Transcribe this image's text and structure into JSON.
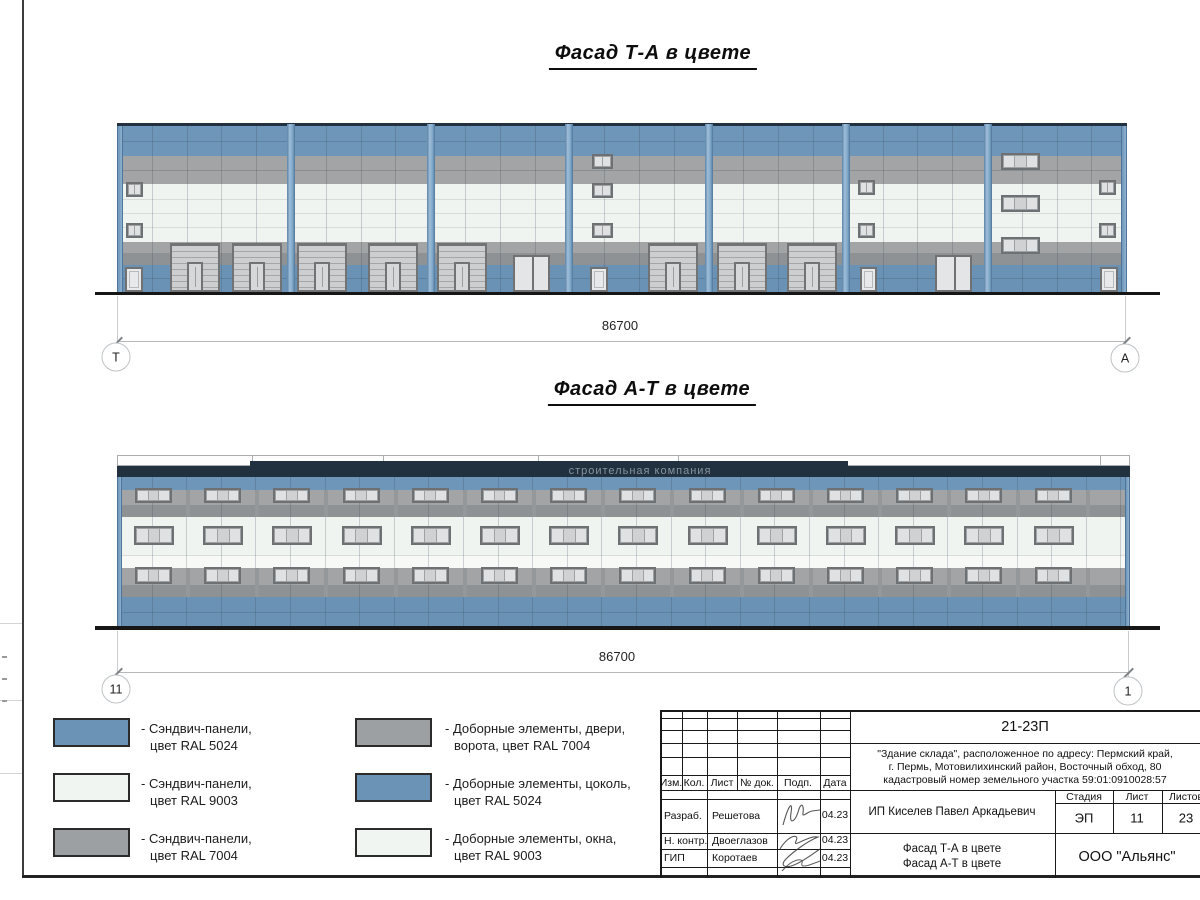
{
  "palette": {
    "blue": "#6e96b8",
    "blue_socle": "#6a92b4",
    "white_panel": "#f0f4f1",
    "white_panel2": "#f6f9f6",
    "gray": "#a2a4a6",
    "gray_dark": "#8f9294",
    "parapet": "#22313f",
    "joint": "rgba(50,65,80,0.22)",
    "white_joint": "#d9ddda",
    "ground": "#161616"
  },
  "titles": {
    "facade_ta": "Фасад Т-А в цвете",
    "facade_at": "Фасад А-Т в цвете"
  },
  "watermark": {
    "text": "строительная компания"
  },
  "dims": {
    "ta": {
      "value": "86700",
      "left": "Т",
      "right": "А"
    },
    "at": {
      "value": "86700",
      "left": "11",
      "right": "1"
    }
  },
  "legend": [
    {
      "swatch": "#6b93b6",
      "line1": "- Сэндвич-панели,",
      "line2": "цвет RAL 5024"
    },
    {
      "swatch": "#f1f5f2",
      "line1": "- Сэндвич-панели,",
      "line2": "цвет RAL 9003"
    },
    {
      "swatch": "#9da0a2",
      "line1": "- Сэндвич-панели,",
      "line2": "цвет RAL 7004"
    },
    {
      "swatch": "#9da0a2",
      "line1": "- Доборные элементы, двери,",
      "line2": "ворота, цвет RAL 7004"
    },
    {
      "swatch": "#6b93b6",
      "line1": "- Доборные элементы, цоколь,",
      "line2": "цвет RAL 5024"
    },
    {
      "swatch": "#f1f5f2",
      "line1": "- Доборные элементы, окна,",
      "line2": "цвет RAL 9003"
    }
  ],
  "title_block": {
    "doc_number": "21-23П",
    "address_lines": [
      "\"Здание склада\", расположенное по адресу: Пермский край,",
      "г. Пермь, Мотовилихинский район, Восточный обход, 80",
      "кадастровый номер земельного участка 59:01:0910028:57"
    ],
    "columns": [
      "Изм.",
      "Кол.",
      "Лист",
      "№ док.",
      "Подп.",
      "Дата"
    ],
    "signers": [
      {
        "role": "Разраб.",
        "name": "Решетова",
        "date": "04.23"
      },
      {
        "role": "Н. контр.",
        "name": "Двоеглазов",
        "date": "04.23"
      },
      {
        "role": "ГИП",
        "name": "Коротаев",
        "date": "04.23"
      }
    ],
    "client": "ИП Киселев Павел Аркадьевич",
    "stage_cols": [
      "Стадия",
      "Лист",
      "Листов"
    ],
    "stage_vals": [
      "ЭП",
      "11",
      "23"
    ],
    "sheet_titles": [
      "Фасад Т-А в цвете",
      "Фасад А-Т в цвете"
    ],
    "company": "ООО \"Альянс\""
  },
  "drawing": {
    "facade_ta": {
      "x": 117,
      "w": 1010,
      "top": 123,
      "bottom": 292,
      "bands": [
        {
          "y": 126,
          "h": 30,
          "color": "blue",
          "joints": [
            141
          ]
        },
        {
          "y": 156,
          "h": 28,
          "color": "gray",
          "joints": [
            170
          ]
        },
        {
          "y": 184,
          "h": 58,
          "color": "white_panel",
          "joints": [
            199,
            213,
            227
          ],
          "jcolor": "white_joint"
        },
        {
          "y": 242,
          "h": 23,
          "color": "gray",
          "dark_from": 253
        },
        {
          "y": 265,
          "h": 27,
          "color": "blue_socle",
          "joints": [
            278
          ]
        }
      ],
      "vstep": 34.8,
      "pilasters": [
        287,
        427,
        565,
        705,
        842,
        984
      ],
      "gates": {
        "xs": [
          170,
          232,
          297,
          368,
          437,
          648,
          717,
          787
        ],
        "y": 243,
        "w": 50,
        "h": 49
      },
      "doors": [
        [
          125,
          267,
          18,
          25
        ],
        [
          590,
          267,
          18,
          25
        ],
        [
          860,
          267,
          17,
          25
        ],
        [
          1100,
          267,
          18,
          25
        ]
      ],
      "double_doors": [
        [
          513,
          255,
          37,
          37
        ],
        [
          935,
          255,
          37,
          37
        ]
      ],
      "windows": [
        [
          126,
          182,
          17,
          15,
          2
        ],
        [
          126,
          223,
          17,
          15,
          2
        ],
        [
          858,
          180,
          17,
          15,
          2
        ],
        [
          858,
          223,
          17,
          15,
          2
        ],
        [
          1099,
          180,
          17,
          15,
          2
        ],
        [
          1099,
          223,
          17,
          15,
          2
        ],
        [
          592,
          154,
          21,
          15,
          2
        ],
        [
          592,
          183,
          21,
          15,
          2
        ],
        [
          592,
          223,
          21,
          15,
          2
        ],
        [
          1001,
          153,
          39,
          17,
          3
        ],
        [
          1001,
          195,
          39,
          17,
          3
        ],
        [
          1001,
          237,
          39,
          17,
          3
        ]
      ],
      "ground": [
        95,
        292,
        1065,
        3
      ]
    },
    "facade_at": {
      "x": 117,
      "w": 1013,
      "top": 455,
      "bottom": 627,
      "cap": {
        "y": 455,
        "h": 11,
        "joints": [
          252,
          383,
          538,
          678,
          1100
        ]
      },
      "parapet": {
        "y": 466,
        "h": 11,
        "raised": {
          "x": 250,
          "w": 598,
          "y": 461,
          "h": 16
        }
      },
      "bands": [
        {
          "y": 477,
          "h": 13,
          "color": "blue"
        },
        {
          "y": 490,
          "h": 27,
          "color": "gray",
          "dark_from": 505
        },
        {
          "y": 517,
          "h": 38,
          "color": "white_panel"
        },
        {
          "y": 555,
          "h": 13,
          "color": "white_panel2",
          "joints": [
            555
          ],
          "jcolor": "white_joint"
        },
        {
          "y": 568,
          "h": 29,
          "color": "gray",
          "dark_from": 585
        },
        {
          "y": 597,
          "h": 31,
          "color": "blue_socle",
          "joints": [
            612
          ]
        }
      ],
      "vstep": 34.6,
      "strip_x0": 186,
      "strip_step": 69.2,
      "strip_w": 4,
      "win_x0": 135,
      "win_step": 69.2,
      "win_count": 14,
      "win_rows": [
        {
          "y": 488,
          "h": 15,
          "w": 37,
          "dx": 0
        },
        {
          "y": 526,
          "h": 19,
          "w": 40,
          "dx": -1
        },
        {
          "y": 567,
          "h": 17,
          "w": 37,
          "dx": 0
        }
      ],
      "ground": [
        95,
        626,
        1065,
        4
      ]
    },
    "dim_ta": {
      "line_y": 341,
      "x1": 117,
      "x2": 1125,
      "ext_top": 296,
      "label_x": 620,
      "label_y": 318,
      "m_left": [
        116,
        357
      ],
      "m_right": [
        1125,
        358
      ]
    },
    "dim_at": {
      "line_y": 672,
      "x1": 117,
      "x2": 1128,
      "ext_top": 631,
      "label_x": 617,
      "label_y": 649,
      "m_left": [
        116,
        689
      ],
      "m_right": [
        1128,
        691
      ]
    }
  }
}
